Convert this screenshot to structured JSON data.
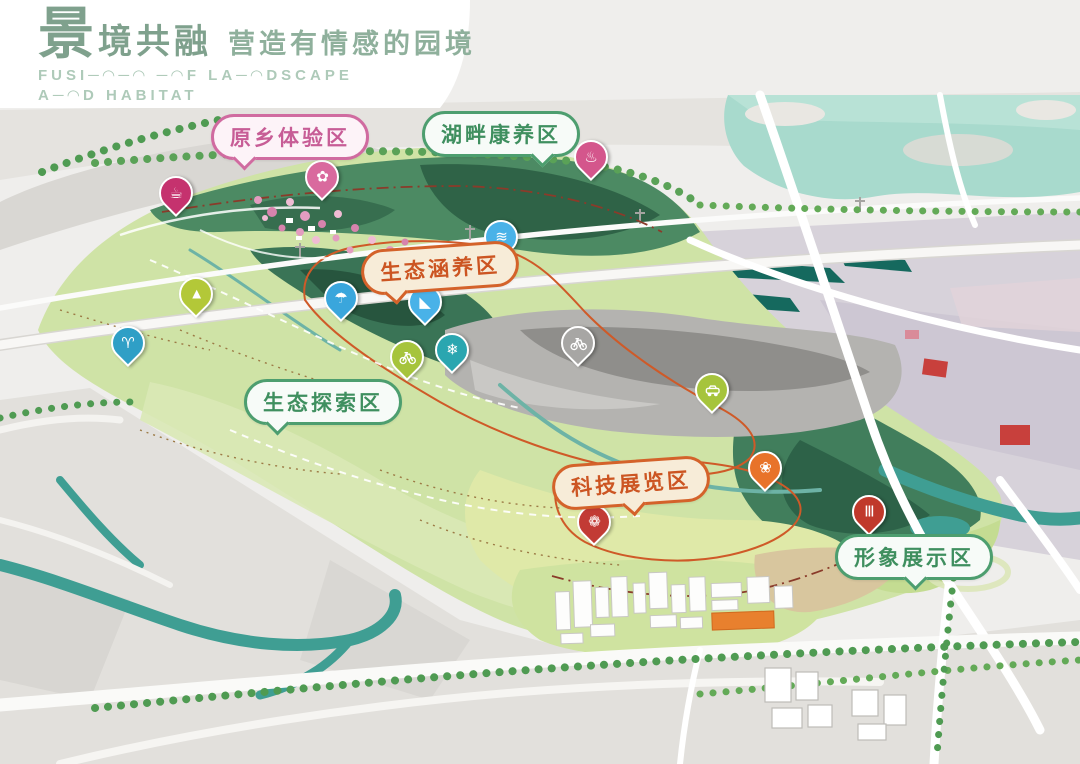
{
  "header": {
    "title_char": "景",
    "title_rest": "境共融",
    "subtitle_cn": "营造有情感的园境",
    "subtitle_en_line1": "FUSI─◠─◠  ─◠F LA─◠DSCAPE",
    "subtitle_en_line2": "A─◠D HABITAT",
    "title_color": "#7fa18d",
    "subtitle_en_color": "#aecab9"
  },
  "map": {
    "zone_styles": {
      "pink": {
        "border": "#d06ba0",
        "bg": "#fdf3f8",
        "text": "#c75d96"
      },
      "green": {
        "border": "#4d9e6f",
        "bg": "#f7fbf8",
        "text": "#3f8f5f"
      },
      "orange": {
        "border": "#d4622a",
        "bg": "#f7ecd8",
        "text": "#cc5522"
      }
    },
    "zones": [
      {
        "id": "yuanxiang",
        "label": "原乡体验区",
        "style": "pink",
        "x": 290,
        "y": 137,
        "tail": "bl",
        "tilt": 0
      },
      {
        "id": "hupan",
        "label": "湖畔康养区",
        "style": "green",
        "x": 501,
        "y": 134,
        "tail": "br",
        "tilt": 0
      },
      {
        "id": "hanyang",
        "label": "生态涵养区",
        "style": "orange",
        "x": 440,
        "y": 268,
        "tail": "bl",
        "tilt": -4
      },
      {
        "id": "tansuo",
        "label": "生态探索区",
        "style": "green",
        "x": 323,
        "y": 402,
        "tail": "bl",
        "tilt": 0
      },
      {
        "id": "keji",
        "label": "科技展览区",
        "style": "orange",
        "x": 631,
        "y": 483,
        "tail": "bc",
        "tilt": -4
      },
      {
        "id": "xingxiang",
        "label": "形象展示区",
        "style": "green",
        "x": 914,
        "y": 557,
        "tail": "bc",
        "tilt": 0
      }
    ],
    "pins": [
      {
        "name": "teapot-pin",
        "icon": "teapot-icon",
        "glyph": "☕",
        "color": "#c5326e",
        "x": 176,
        "y": 222
      },
      {
        "name": "blossom-pin",
        "icon": "blossom-icon",
        "glyph": "✿",
        "color": "#d96a9e",
        "x": 322,
        "y": 206
      },
      {
        "name": "wellness-pin",
        "icon": "wellness-icon",
        "glyph": "♨",
        "color": "#d4568c",
        "x": 591,
        "y": 186
      },
      {
        "name": "waterfall-pin",
        "icon": "waterfall-icon",
        "glyph": "≋",
        "color": "#49b2e8",
        "x": 501,
        "y": 266
      },
      {
        "name": "fountain-pin",
        "icon": "fountain-icon",
        "glyph": "☂",
        "color": "#3aa6dc",
        "x": 341,
        "y": 327
      },
      {
        "name": "skate-pin",
        "icon": "skate-icon",
        "glyph": "◣",
        "color": "#49b2e8",
        "x": 425,
        "y": 331
      },
      {
        "name": "hiking-pin",
        "icon": "hiking-icon",
        "glyph": "▲",
        "color": "#b3c838",
        "x": 196,
        "y": 323
      },
      {
        "name": "rabbit-pin",
        "icon": "rabbit-icon",
        "glyph": "♈",
        "color": "#2f9fc6",
        "x": 128,
        "y": 372
      },
      {
        "name": "bicycle-pin",
        "icon": "bicycle-icon",
        "shape": "bicycle",
        "color": "#a6c43c",
        "x": 407,
        "y": 386
      },
      {
        "name": "snowflake-pin",
        "icon": "snowflake-icon",
        "glyph": "❄",
        "color": "#2aa6b0",
        "x": 452,
        "y": 379
      },
      {
        "name": "quarry-bicycle-pin",
        "icon": "bicycle-icon",
        "shape": "bicycle",
        "color": "rgba(255,255,255,0.22)",
        "variant": "outline",
        "x": 578,
        "y": 372
      },
      {
        "name": "car-pin",
        "icon": "car-icon",
        "shape": "car",
        "color": "#a6c43c",
        "x": 712,
        "y": 419
      },
      {
        "name": "industry-flower-pin",
        "icon": "industry-flower-icon",
        "glyph": "❀",
        "color": "#e8732a",
        "x": 765,
        "y": 497
      },
      {
        "name": "flower-pin",
        "icon": "flower-icon",
        "glyph": "❁",
        "color": "#c23b35",
        "x": 594,
        "y": 551
      },
      {
        "name": "museum-pin",
        "icon": "museum-icon",
        "glyph": "Ⅲ",
        "color": "#c0392b",
        "x": 869,
        "y": 541
      }
    ]
  }
}
